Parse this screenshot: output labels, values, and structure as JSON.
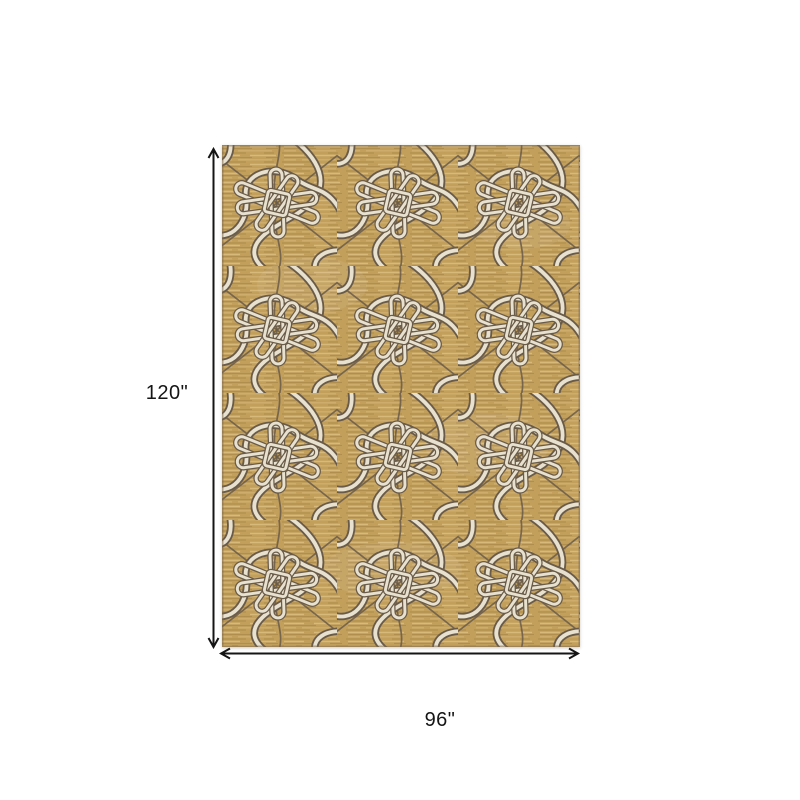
{
  "page": {
    "background": "#ffffff",
    "description": "Product dimensions diagram of a rectangular area rug"
  },
  "diagram": {
    "item": "area rug",
    "pattern_description": "abstract interlocking knot and boomerang curve pattern on gold ground",
    "height_label": "120\"",
    "width_label": "96\"",
    "height_value_inches": 120,
    "width_value_inches": 96
  },
  "icons": {
    "vertical_arrow": "double-headed-arrow-vertical",
    "horizontal_arrow": "double-headed-arrow-horizontal"
  },
  "colors": {
    "page_bg": "#ffffff",
    "line_color": "#151515",
    "rug_base": "#c2a05c",
    "streak_light": "#dcc084",
    "streak_dark": "#ab894b",
    "streak_mid": "#d0ae6e",
    "streak_deep": "#9d7d42",
    "pattern_cream": "#e8e1cf",
    "pattern_dark": "#6a5b49",
    "rug_edge": "#7d6a4f"
  }
}
